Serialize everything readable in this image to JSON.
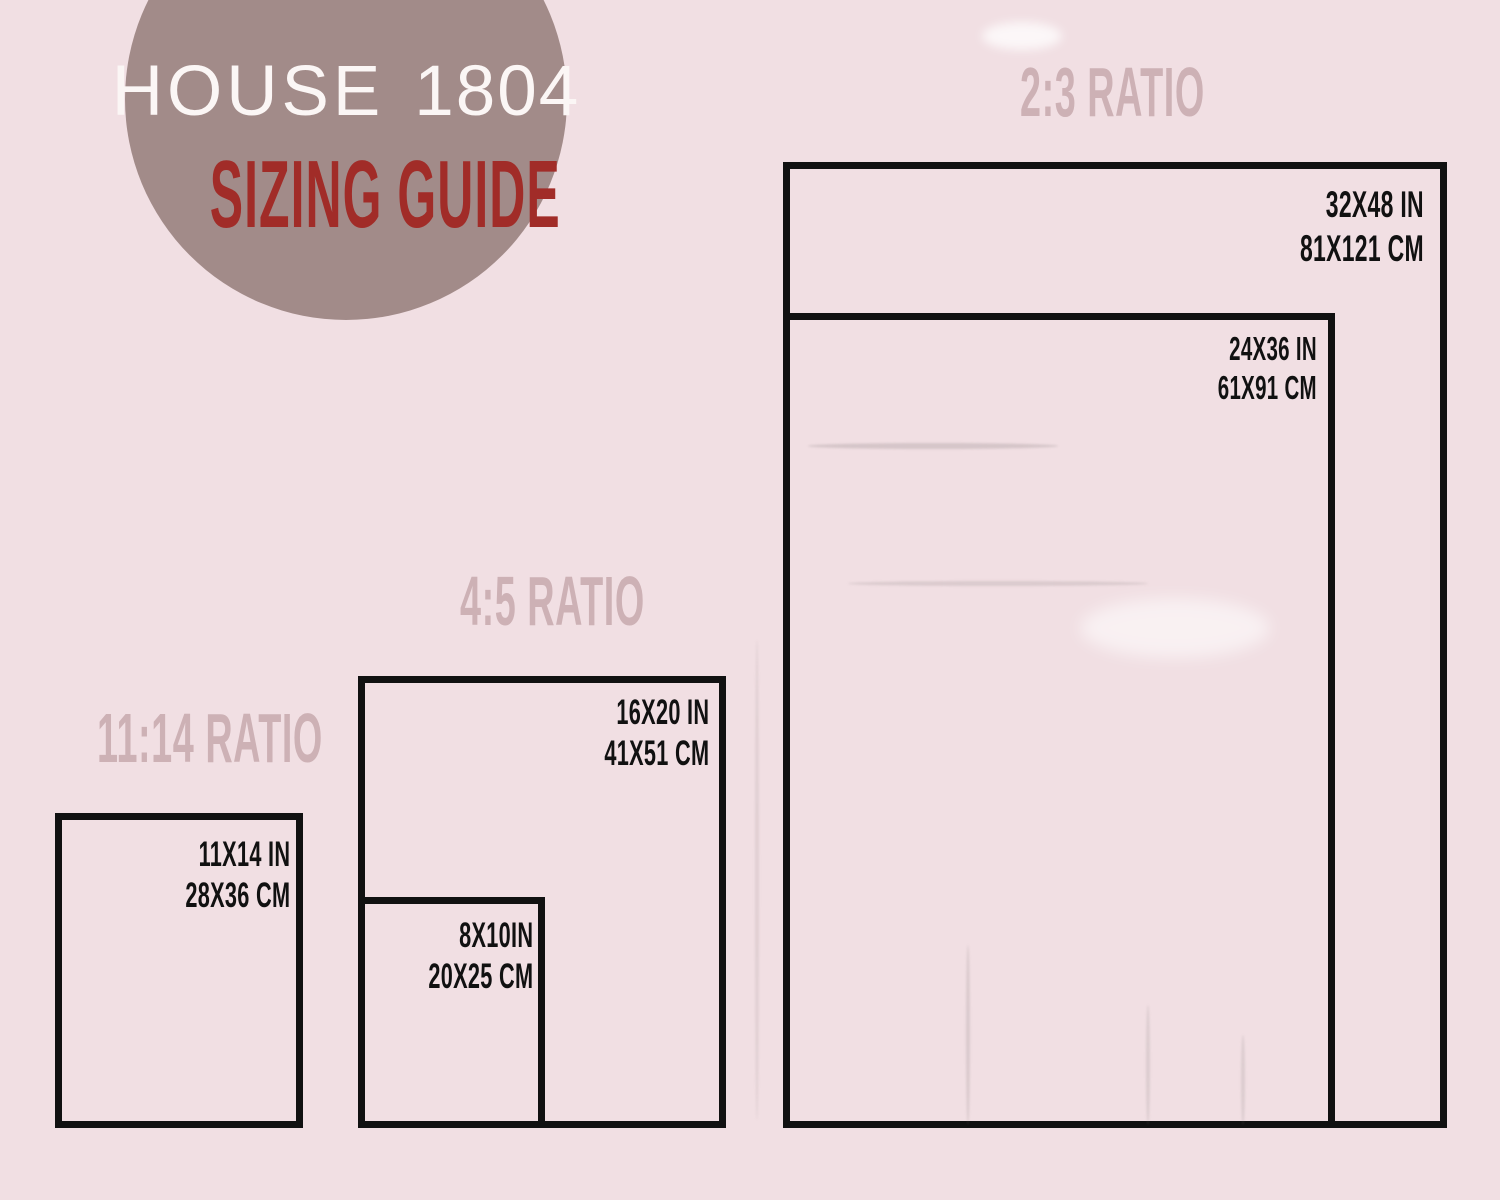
{
  "logo": {
    "brand": "HOUSE",
    "divider": "|",
    "year": "1804",
    "subtitle": "SIZING GUIDE"
  },
  "ratios": [
    {
      "label": "2:3 RATIO",
      "rects": [
        {
          "name": "32x48",
          "inches": "32X48 IN",
          "cm": "81X121 CM"
        },
        {
          "name": "24x36",
          "inches": "24X36 IN",
          "cm": "61X91 CM"
        }
      ]
    },
    {
      "label": "4:5 RATIO",
      "rects": [
        {
          "name": "16x20",
          "inches": "16X20 IN",
          "cm": "41X51 CM"
        },
        {
          "name": "8x10",
          "inches": "8X10IN",
          "cm": "20X25 CM"
        }
      ]
    },
    {
      "label": "11:14 RATIO",
      "rects": [
        {
          "name": "11x14",
          "inches": "11X14 IN",
          "cm": "28X36 CM"
        }
      ]
    }
  ],
  "colors": {
    "background": "#f1dfe3",
    "circle": "#a28b89",
    "brand_text": "#fbf6f5",
    "subtitle_text": "#a12c28",
    "ratio_label": "#cdb1b5",
    "outline": "#111111"
  }
}
